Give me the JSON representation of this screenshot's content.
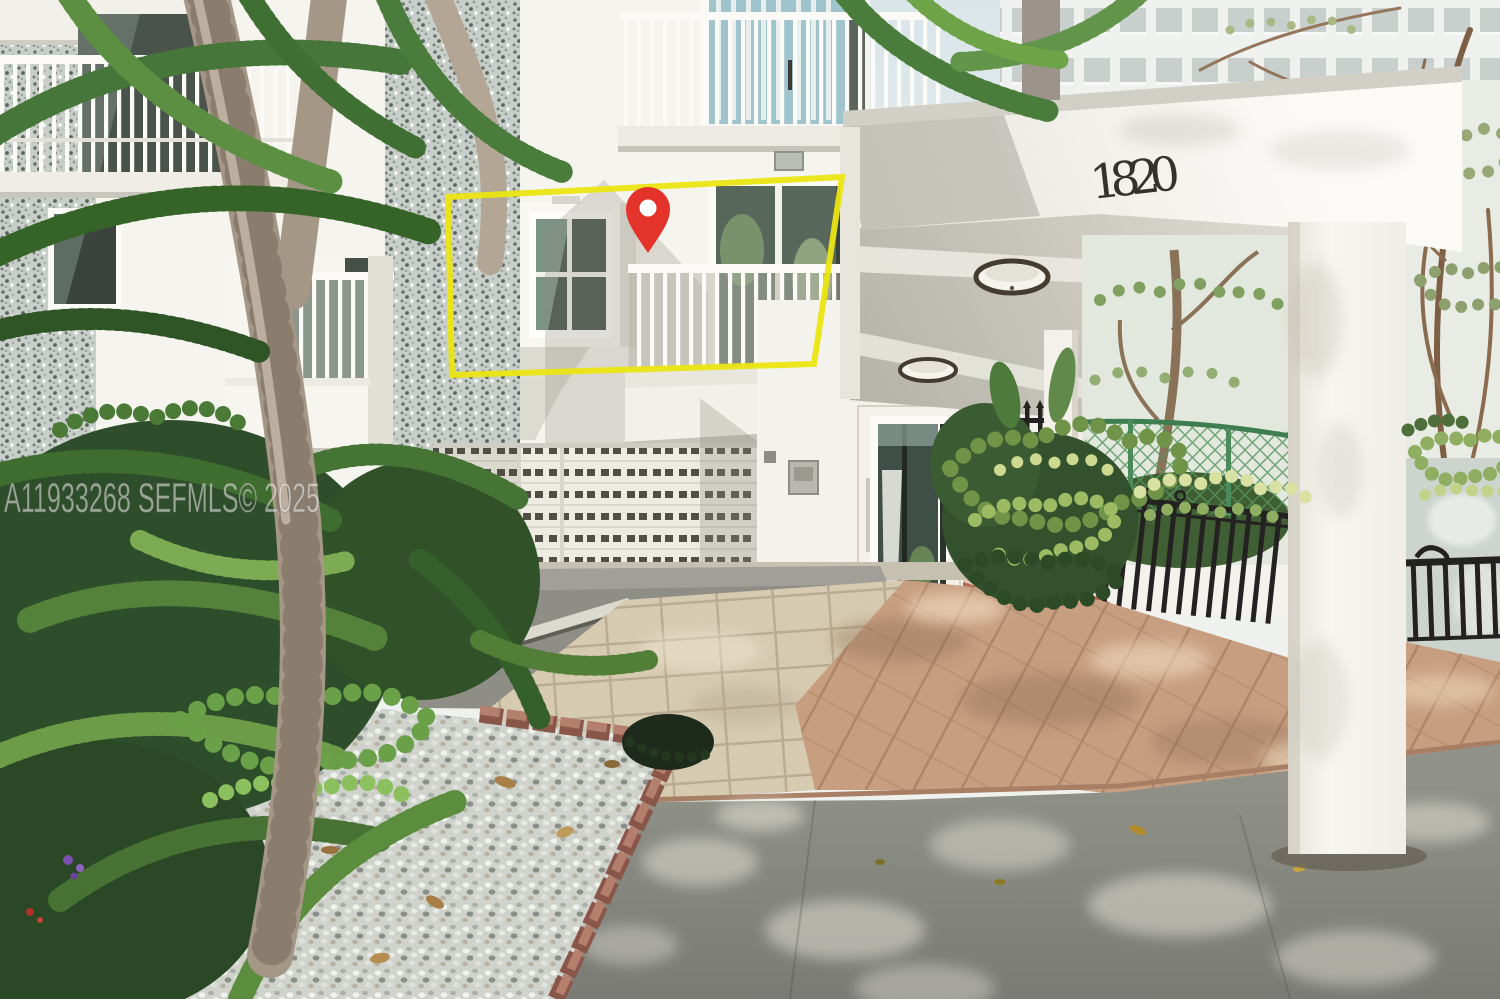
{
  "meta": {
    "type": "real-estate-listing-photo",
    "subject": "White condo building entrance with a unit highlighted by a yellow box and red map pin"
  },
  "watermark": {
    "text": "A11933268 SEFMLS© 2025",
    "color": "#f2f2f0",
    "opacity": 0.55
  },
  "building": {
    "number": "1820",
    "number_color": "#34322d"
  },
  "annotations": {
    "highlight_box": {
      "name": "unit-highlight-box",
      "color": "#ebe512"
    },
    "location_pin": {
      "name": "location-pin-icon",
      "color": "#e4332b",
      "hole_color": "#ffffff"
    }
  },
  "palette": {
    "sky": "#dce6ea",
    "facade_white": "#f5f4ef",
    "pebble_wall": "#c8cec9",
    "canopy_ceiling": "#c6c3bb",
    "brick": "#b2604a",
    "paver_walkway": "#c79e80",
    "tile_walkway": "#d6cab0",
    "concrete_driveway": "#82847d",
    "gravel": "#cfd3cc",
    "foliage_dark": "#2e4d2a",
    "foliage_mid": "#5e8044",
    "foliage_light": "#a8c173",
    "fence_black": "#242220",
    "chainlink_green": "#57955f",
    "trunk": "#a59786"
  }
}
